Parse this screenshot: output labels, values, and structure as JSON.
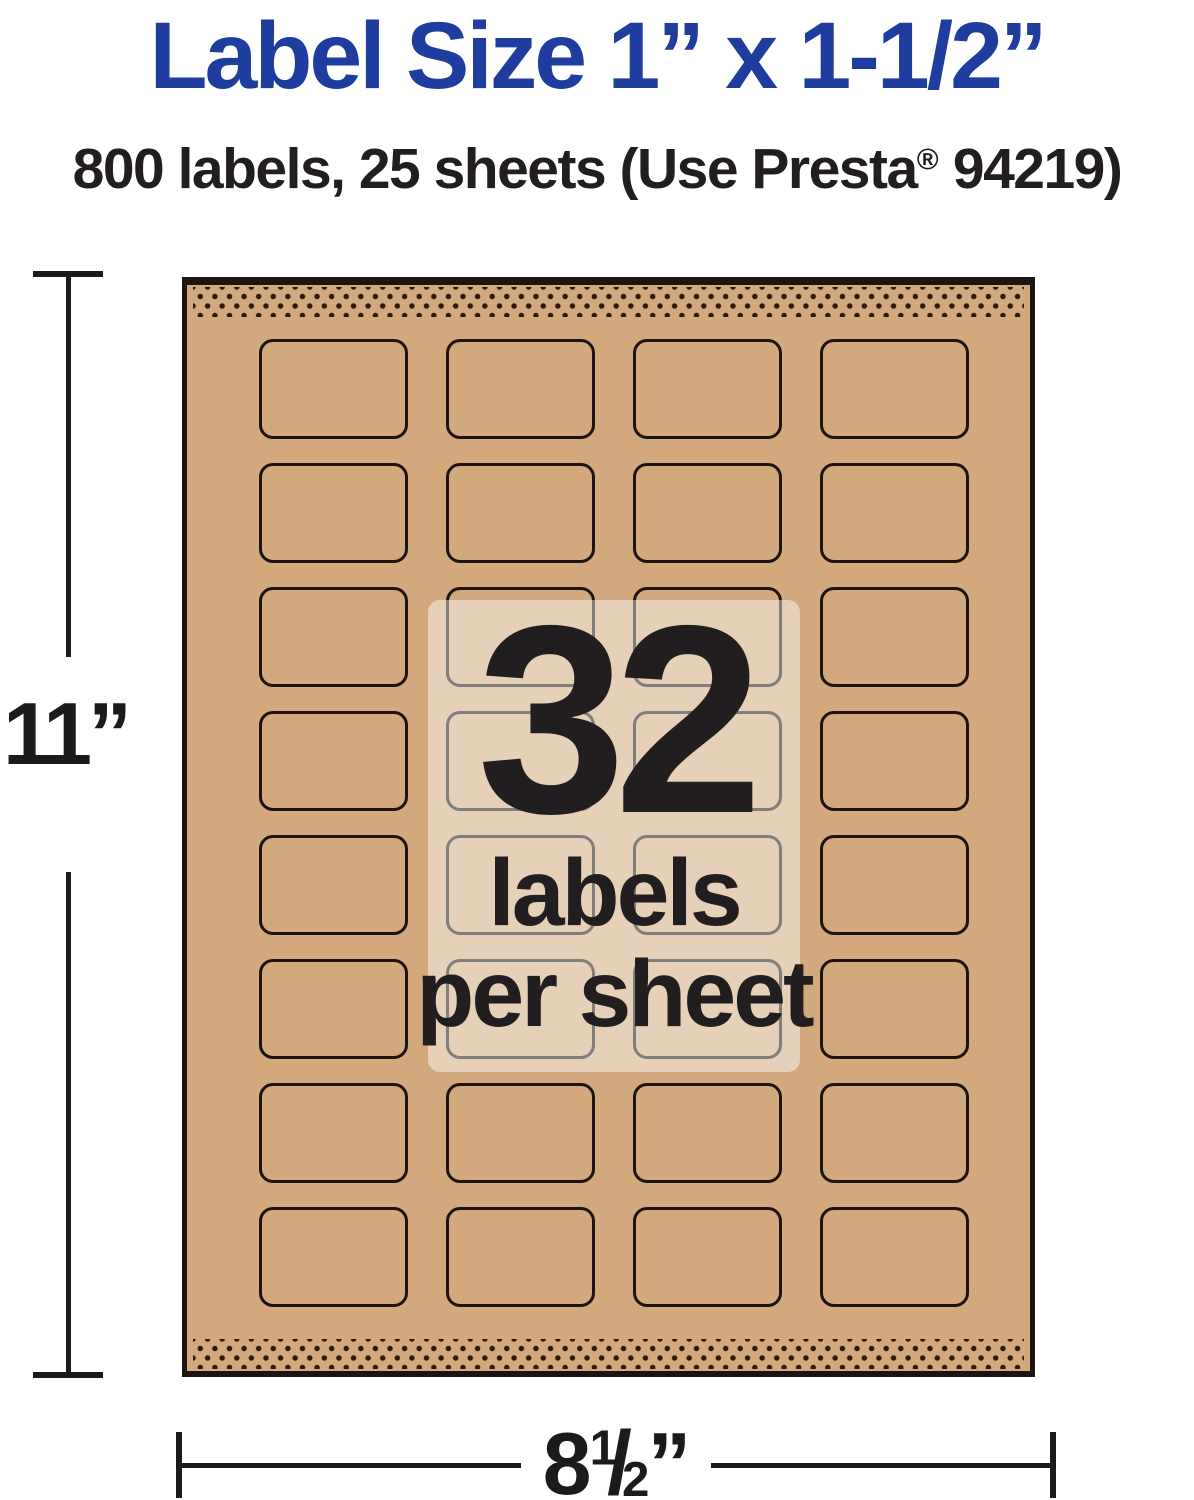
{
  "title": "Label Size 1” x 1-1/2”",
  "subtitle": {
    "before": "800 labels, 25 sheets (Use Presta",
    "registered_mark": "®",
    "after": " 94219)"
  },
  "sheet": {
    "labels_per_sheet": "32",
    "caption_line2": "labels",
    "caption_line3": "per sheet",
    "grid": {
      "rows": 8,
      "columns": 4
    }
  },
  "dimensions": {
    "height": "11”",
    "width": {
      "whole": "8",
      "numerator": "1",
      "slash": "/",
      "denominator": "2",
      "unit": "”"
    }
  },
  "colors": {
    "blue": "#1e3d9e",
    "ink": "#221e1f",
    "kraft": "#d2a97c",
    "outline": "#1c1410",
    "dots": "#2a1a0c",
    "dim": "#1b1b1b",
    "overlay": "rgba(255,255,255,0.45)"
  }
}
